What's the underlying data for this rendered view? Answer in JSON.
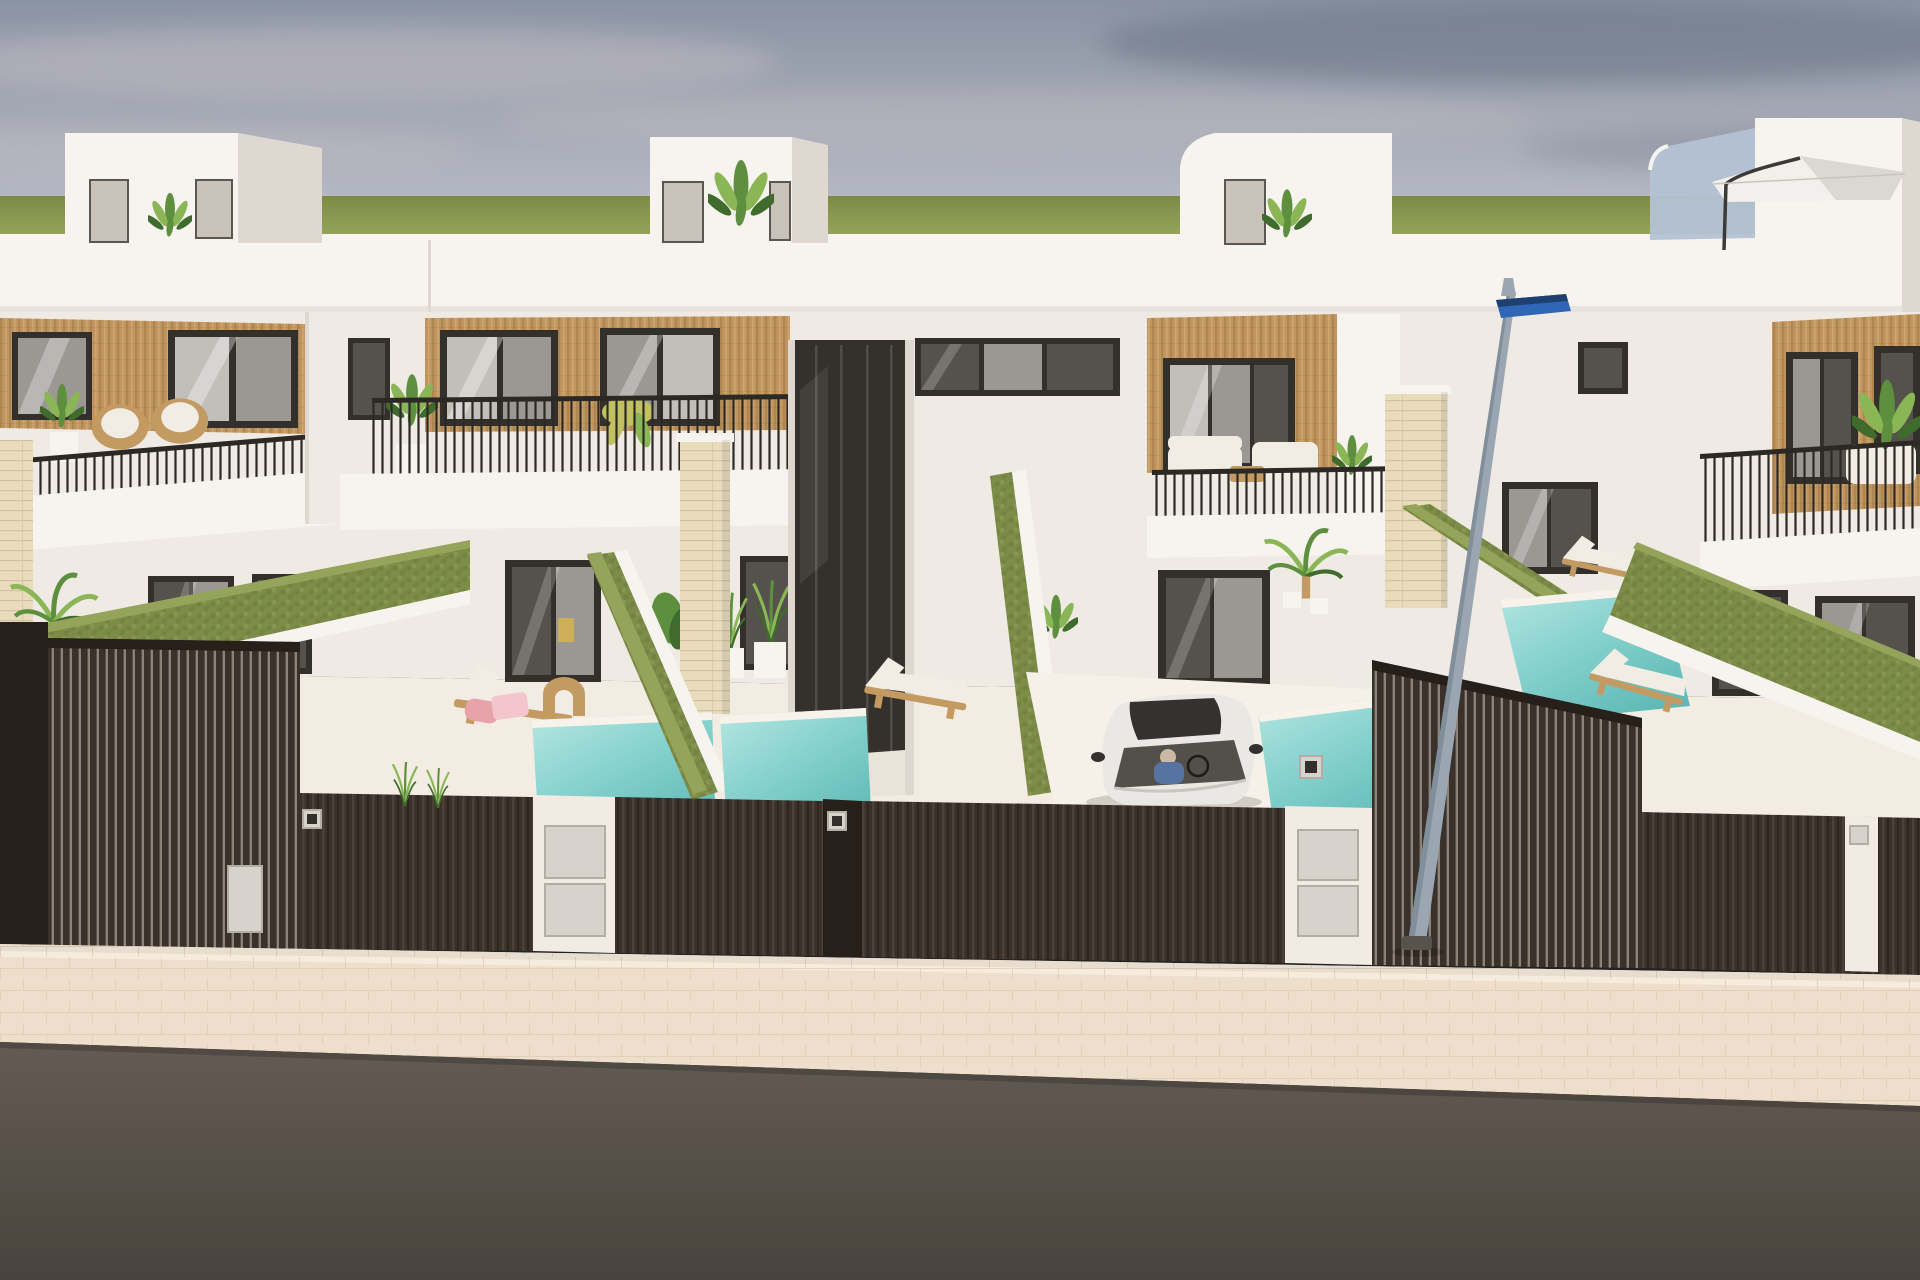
{
  "scene": {
    "kind": "3d-architectural-render",
    "subject": "Street view of a row of modern white two-storey villas with wood-slat accents, rooftop terraces, balconies, private plunge pools, dark slatted street fence with gates, a white car in a driveway, a blue-headed street lamp, a tiled sidewalk and an asphalt road",
    "camera": "elevated view from across the street",
    "time_of_day": "daytime, overcast-hazy sky"
  },
  "palette": {
    "sky_top": "#8a93a4",
    "sky_mid": "#a6aab5",
    "sky_low": "#bdc0ca",
    "cloud_light": "#c8bfc5",
    "cloud_dark": "#6b7485",
    "grass": "#8e9b52",
    "grass_dark": "#7c8b45",
    "grass_light": "#9ca95e",
    "wall": "#efeae4",
    "wall_lit": "#f7f4f0",
    "wall_shade": "#ded8d1",
    "wall_dark": "#c9c2bb",
    "wood": "#c1955f",
    "wood_dark": "#9d7a47",
    "wood_light": "#d6ae77",
    "frame": "#332f2b",
    "glass": "#9b9894",
    "glass_dark": "#55514c",
    "glass_light": "#c2bfba",
    "rail": "#2c2925",
    "hedge": "#7d8d48",
    "hedge_dark": "#69793c",
    "hedge_light": "#95a45a",
    "stone": "#e8dcbd",
    "stone_line": "#d2c29e",
    "pool_light": "#b7e7e2",
    "pool_mid": "#85d1cd",
    "pool_dark": "#5fb9b6",
    "fence": "#39312a",
    "fence_rib": "#4a4138",
    "fence_gap": "#8c8378",
    "fence_post": "#261f1a",
    "pier": "#f1ebe4",
    "meter": "#d7d2cb",
    "meter_edge": "#b3ada6",
    "walk": "#eedfcc",
    "walk_line": "#dcc9b2",
    "curb": "#f6ecdd",
    "road": "#635b54",
    "road_dark": "#4a433d",
    "car": "#eae8e4",
    "car_shade": "#c9c6c1",
    "car_glass": "#534f4a",
    "car_dark": "#343130",
    "driver": "#56749f",
    "pole": "#9aa6b2",
    "pole_dark": "#727f8c",
    "lamp_blue": "#2f66b5",
    "lamp_blue_dark": "#1e4071",
    "base": "#57524c",
    "leaf": "#5d8f3e",
    "leaf_light": "#8ab655",
    "leaf_dark": "#3f6b2d",
    "leaf_yellow": "#c2c162",
    "wicker": "#c49a63",
    "cushion": "#f1ede5",
    "towel": "#e8a2aa",
    "towel2": "#f2c6cc",
    "umbrella": "#f2f0ec",
    "umbrella_shade": "#dbd7d1",
    "floor": "#f2ece2",
    "floor_bright": "#f6f1e8",
    "bal_glass": "#b4c2d4"
  },
  "objects": {
    "sky": {
      "clouds": "soft horizontal haze streaks, darker at top right"
    },
    "grass_horizon": {
      "position": "flat green band at eye level behind the houses"
    },
    "houses": {
      "count": 4,
      "style": "white cubic villas",
      "features": [
        "rooftop staircase bulkheads with plants",
        "vertical wood-slat cladding around upper windows",
        "black-framed sliding glass doors",
        "thin black balcony railings",
        "balcony furniture (wicker chairs, white sofas)",
        "travertine stone pillars between plots"
      ]
    },
    "rooftop_umbrella": {
      "color": "white",
      "location": "right rooftop terrace with glass balustrade"
    },
    "pools": {
      "count": 5,
      "color": "turquoise",
      "location": "front yards"
    },
    "sun_loungers": {
      "count": 4,
      "details": "wooden frames, cream cushions, pink towels on one"
    },
    "hedges": {
      "color": "olive green",
      "role": "diagonal boundaries between front yards"
    },
    "car": {
      "color": "white",
      "location": "center driveway behind fence",
      "details": "driver visible through windshield, dark sunroof"
    },
    "street_lamp": {
      "pole": "gray, slightly tilted",
      "head": "blue rectangular fixture"
    },
    "fence": {
      "style": "dark brown vertical slats",
      "elements": [
        "tall sliding gates",
        "white piers with utility meter doors",
        "small number plates"
      ]
    },
    "sidewalk": {
      "material": "light beige pavers"
    },
    "road": {
      "material": "dark gray asphalt"
    }
  }
}
